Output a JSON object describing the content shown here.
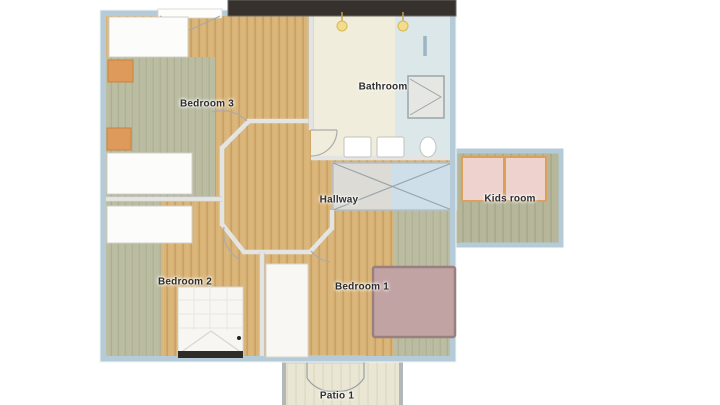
{
  "plan_title": "Upper floor plan",
  "rooms": {
    "bedroom3": {
      "label": "Bedroom 3"
    },
    "bathroom": {
      "label": "Bathroom"
    },
    "hallway": {
      "label": "Hallway"
    },
    "kidsroom": {
      "label": "Kids room"
    },
    "bedroom2": {
      "label": "Bedroom 2"
    },
    "bedroom1": {
      "label": "Bedroom 1"
    },
    "patio": {
      "label": "Patio 1"
    }
  },
  "colors": {
    "exterior_wall": "#b6cbd8",
    "interior_wall": "#e4e5e3",
    "wood_floor": "#d8b478",
    "carpet_green": "#b9bea6",
    "kids_floor": "#b6b69b",
    "bathroom_cream": "#f1eddc",
    "bathroom_blue": "#dbe7e9",
    "stairs_gray": "#dcdbd6",
    "stairs_blue": "#cfdfe9",
    "kids_mat_pink": "#eed2ce",
    "kids_mat_border": "#dca05a",
    "rug_mauve": "#c2a3a3",
    "nightstand_orange": "#dd9a5b",
    "roof_beam_dark": "#36312d",
    "patio_floor": "#eae6d4",
    "label_text": "#2e2e2e"
  },
  "furniture": {
    "bedroom3": [
      "wardrobe",
      "nightstand",
      "dresser",
      "nightstand"
    ],
    "bedroom2": [
      "dresser",
      "double-bed"
    ],
    "bedroom1": [
      "single-bed",
      "rug"
    ],
    "kidsroom": [
      "play-mat",
      "play-mat"
    ],
    "bathroom": [
      "pendant-light",
      "pendant-light",
      "shower-cabin",
      "sink",
      "sink",
      "toilet"
    ],
    "hallway": [
      "stair-void"
    ]
  }
}
